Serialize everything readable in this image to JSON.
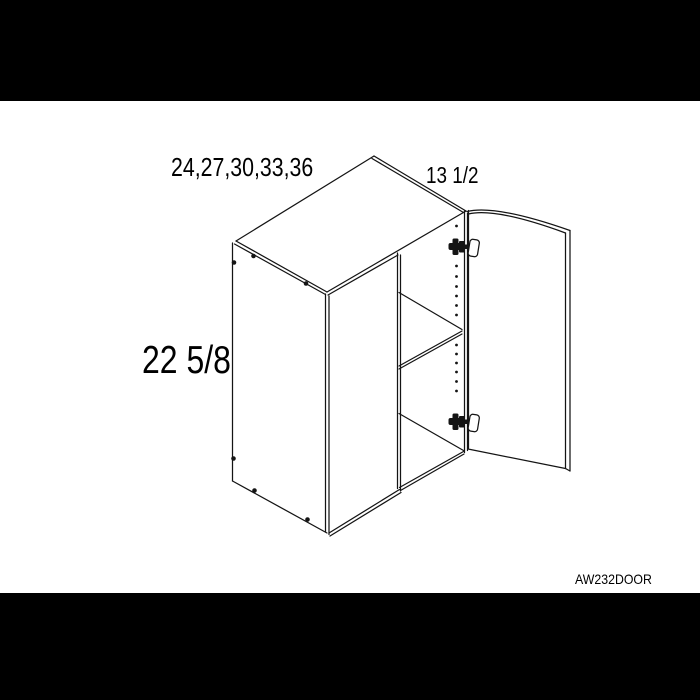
{
  "colors": {
    "band": "#000000",
    "line": "#141414",
    "ink": "#000000",
    "paper": "#ffffff"
  },
  "drawing": {
    "labels": {
      "width_options": "24,27,30,33,36",
      "depth": "13 1/2",
      "height": "22 5/8"
    },
    "product_code": "AW232DOOR"
  }
}
